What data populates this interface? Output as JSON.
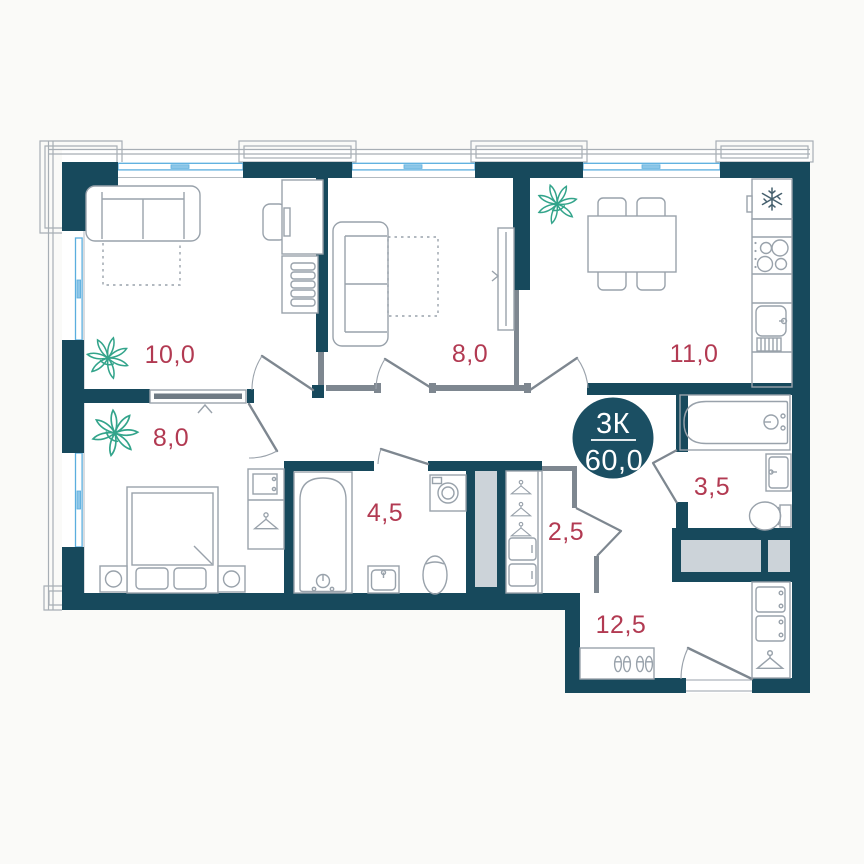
{
  "plan": {
    "badge": {
      "rooms_label": "3К",
      "area_label": "60,0"
    },
    "rooms": [
      {
        "name": "living-room",
        "area_label": "10,0"
      },
      {
        "name": "room-second",
        "area_label": "8,0"
      },
      {
        "name": "kitchen",
        "area_label": "11,0"
      },
      {
        "name": "bedroom",
        "area_label": "8,0"
      },
      {
        "name": "bathroom-main",
        "area_label": "4,5"
      },
      {
        "name": "wardrobe-room",
        "area_label": "2,5"
      },
      {
        "name": "bathroom-small",
        "area_label": "3,5"
      },
      {
        "name": "hallway",
        "area_label": "12,5"
      }
    ],
    "icons": {
      "snowflake-icon": "fridge snowflake",
      "plant-icon": "decorative plant",
      "hanger-icon": "clothes hanger",
      "shoes-icon": "shoe pairs in hallway cabinet"
    },
    "colors": {
      "wall": "#17495c",
      "badge": "#1b4f63",
      "area_label": "#b23a52",
      "window_glass": "#5aaede",
      "plant": "#33a48b",
      "furniture_line": "#99a2ab",
      "shaft_fill": "#ccd3d9",
      "background": "#fafaf8"
    }
  }
}
